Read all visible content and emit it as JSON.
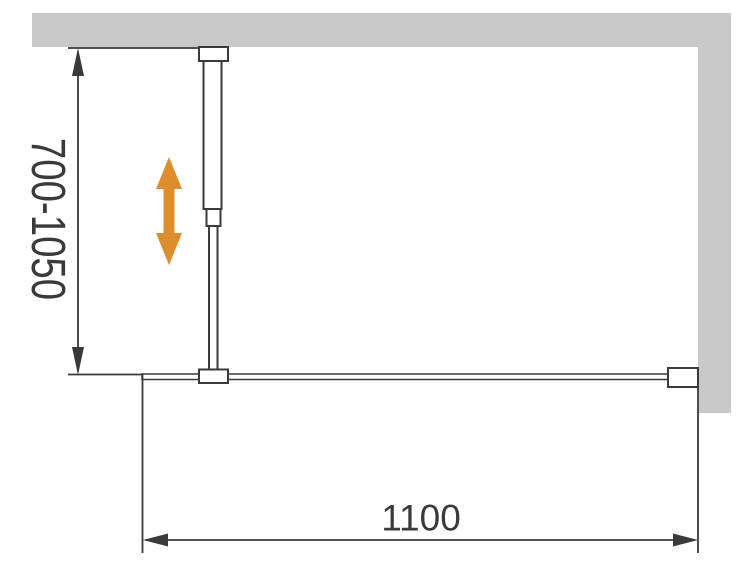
{
  "diagram": {
    "vertical_dimension": {
      "label": "700-1050"
    },
    "horizontal_dimension": {
      "label": "1100"
    },
    "colors": {
      "wall": "#c9c9c9",
      "line": "#3a3a3a",
      "adjustment_arrow": "#de8d2c"
    },
    "icons": {
      "adjustment_arrow": "vertical-double-arrow-icon"
    }
  }
}
